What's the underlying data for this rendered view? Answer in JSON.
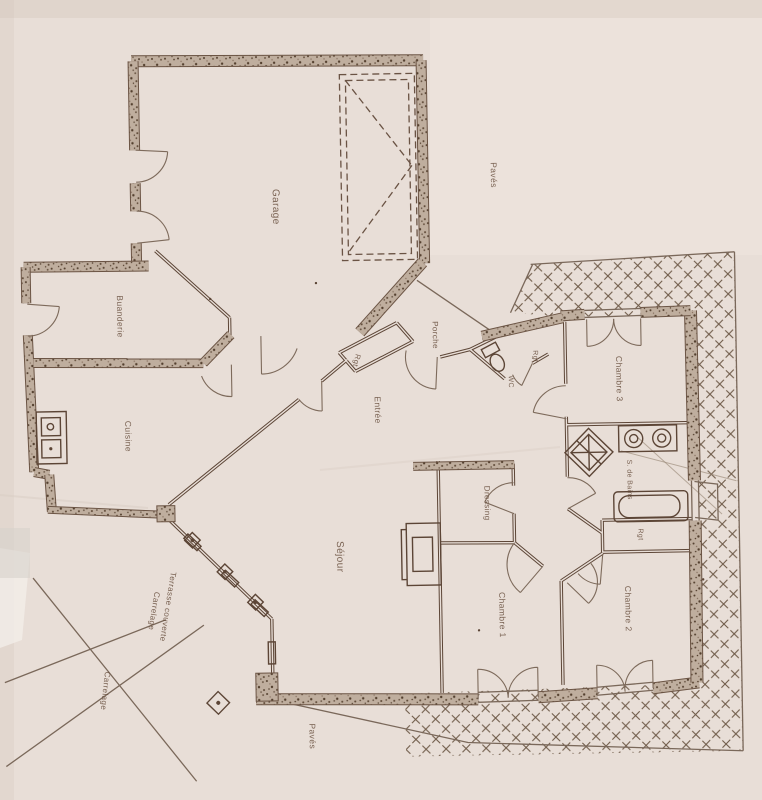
{
  "document": {
    "type": "scanned-floor-plan",
    "colors": {
      "paper": "#e8ded7",
      "ink": "#5c4536",
      "wall_fill": "#bfae9e",
      "hatch": "#6f5b49",
      "label": "#6a5140"
    }
  },
  "labels": {
    "garage": "Garage",
    "paves_top": "Pavés",
    "buanderie": "Buanderie",
    "cuisine": "Cuisine",
    "rgt_hall": "Rgt",
    "porche": "Porche",
    "entree": "Entrée",
    "wc": "WC",
    "rgt_wc": "Rgt",
    "chambre3": "Chambre 3",
    "sdb": "S. de Bains",
    "rgt_sdb": "Rgt",
    "dressing": "Dressing",
    "sejour": "Séjour",
    "chambre1": "Chambre 1",
    "chambre2": "Chambre 2",
    "terrasse": "Terrasse couverte",
    "terrasse_mat": "Carrelage",
    "carrelage_strip": "Carrelage",
    "paves_bottom": "Pavés"
  }
}
